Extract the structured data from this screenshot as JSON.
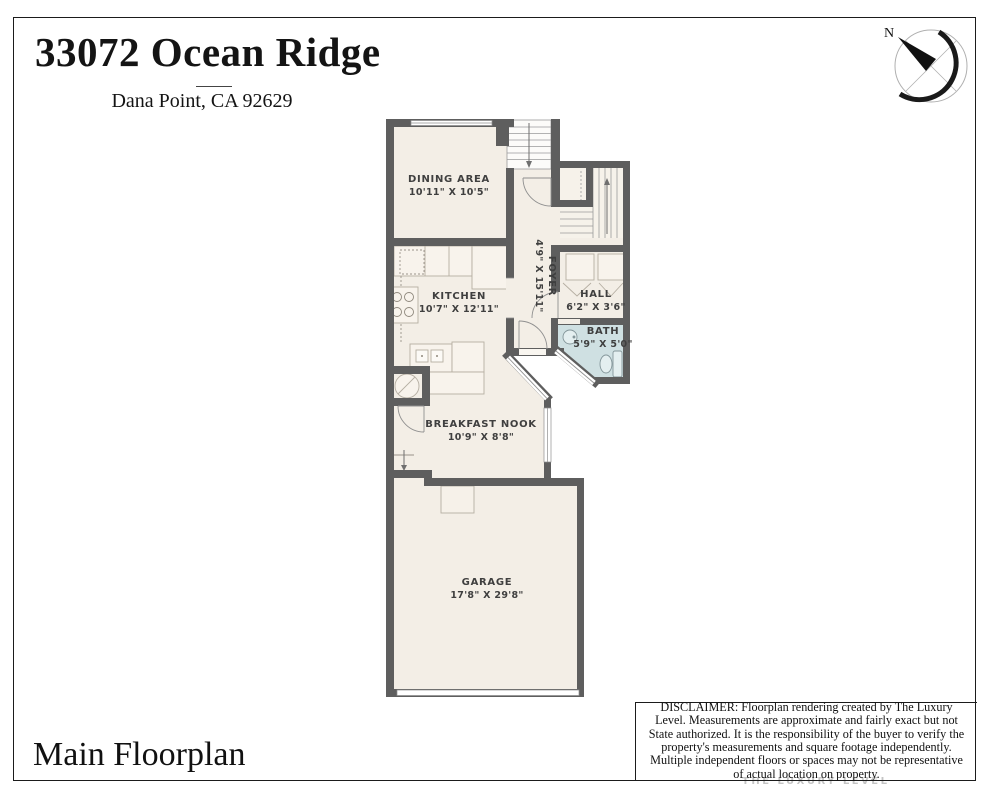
{
  "header": {
    "title": "33072 Ocean Ridge",
    "subtitle": "Dana Point, CA 92629"
  },
  "compass": {
    "label": "N"
  },
  "rooms": {
    "dining": {
      "name": "DINING AREA",
      "dims": "10'11\" X 10'5\""
    },
    "kitchen": {
      "name": "KITCHEN",
      "dims": "10'7\" X 12'11\""
    },
    "foyer": {
      "name": "FOYER",
      "dims": "4'9\" X 15'11\""
    },
    "hall": {
      "name": "HALL",
      "dims": "6'2\" X 3'6\""
    },
    "bath": {
      "name": "BATH",
      "dims": "5'9\" X 5'0\""
    },
    "nook": {
      "name": "BREAKFAST NOOK",
      "dims": "10'9\" X 8'8\""
    },
    "garage": {
      "name": "GARAGE",
      "dims": "17'8\" X 29'8\""
    }
  },
  "footer": {
    "title": "Main Floorplan",
    "disclaimer": "DISCLAIMER: Floorplan rendering created by The Luxury Level. Measurements are approximate and fairly exact but not State authorized. It is the responsibility of the buyer to verify the property's measurements and square footage independently. Multiple independent floors or spaces may not be representative of actual location on property.",
    "watermark": "THE LUXURY LEVEL"
  },
  "colors": {
    "wall": "#5e5e5e",
    "floor": "#f3eee6",
    "bath_floor": "#cfe0e2",
    "accent_black": "#1b1b1b"
  }
}
